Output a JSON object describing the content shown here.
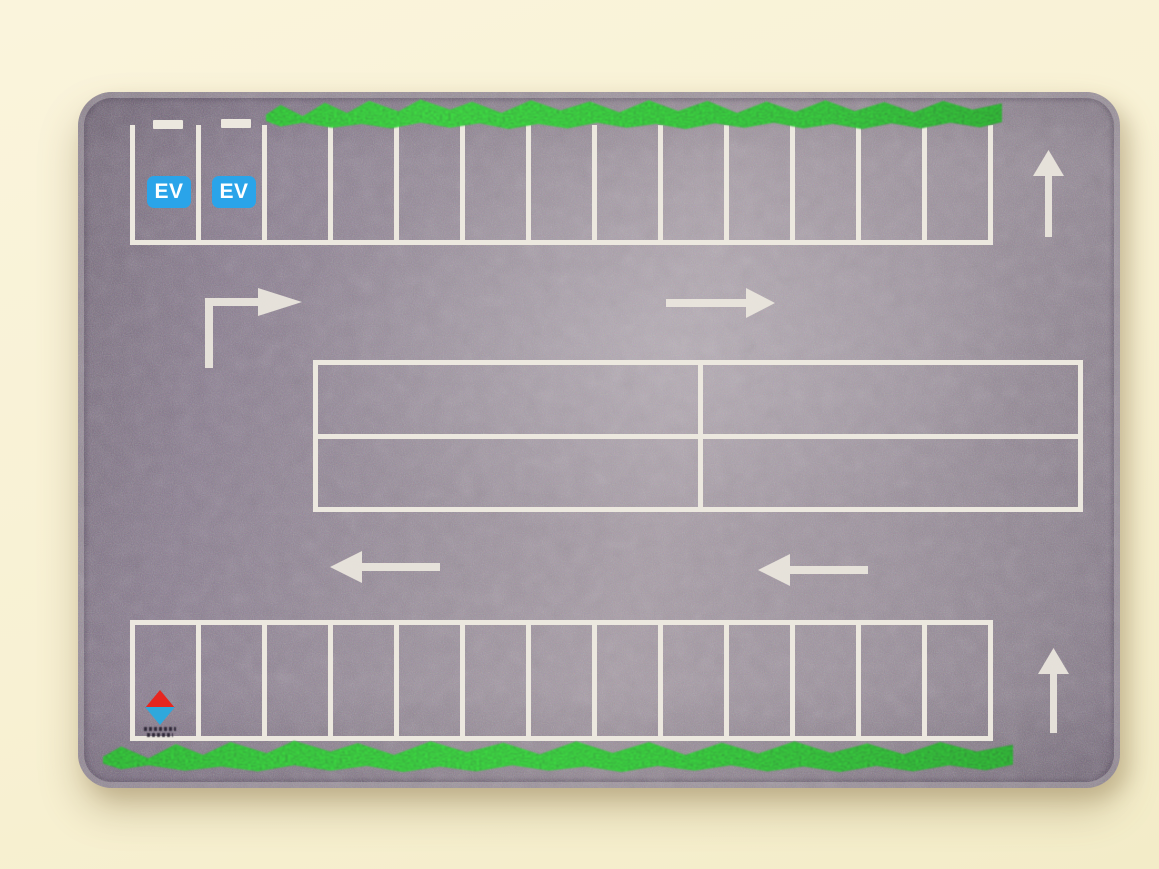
{
  "scene": {
    "subject": "Toy parking lot play mat photographed on a cream table",
    "background_color": "#f8f1d3"
  },
  "mat": {
    "surface": "speckled asphalt",
    "colors": {
      "table": "#f8f1d3",
      "asphalt": "#958a96",
      "marking": "#ece8df",
      "grass": "#2f9133",
      "ev_badge_blue": "#2aa4e9",
      "logo_red": "#e6261f",
      "logo_blue": "#2fa8dc"
    },
    "ev_badges": [
      {
        "label": "EV"
      },
      {
        "label": "EV"
      }
    ],
    "top_row": {
      "stalls": 13,
      "ev_stalls": 2,
      "charger_dashes": 2
    },
    "bottom_row": {
      "stalls": 13
    },
    "center_block": {
      "rows": 2,
      "cols": 2
    },
    "arrows": [
      {
        "name": "turn-right",
        "direction": "up-then-right"
      },
      {
        "name": "straight-right",
        "direction": "right"
      },
      {
        "name": "lane-left-west",
        "direction": "left"
      },
      {
        "name": "lane-left-east",
        "direction": "left"
      },
      {
        "name": "lane-up-north",
        "direction": "up"
      },
      {
        "name": "lane-up-south",
        "direction": "up"
      }
    ],
    "logo": {
      "mark": "red and blue diamond",
      "caption_legible": false
    }
  }
}
